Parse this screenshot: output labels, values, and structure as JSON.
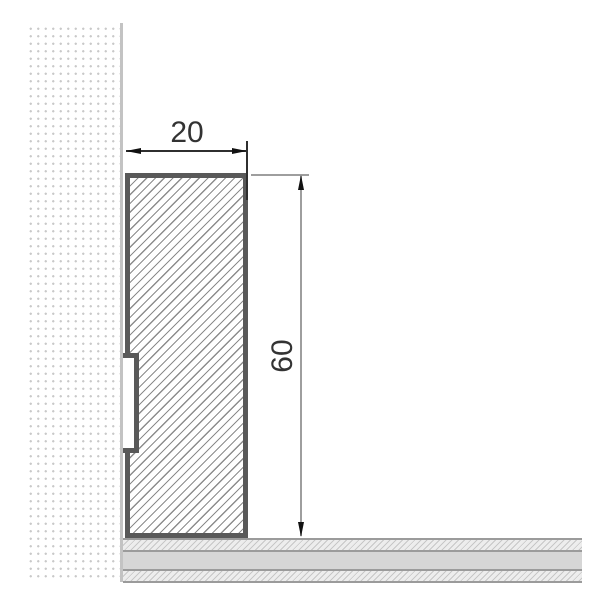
{
  "drawing": {
    "scene": "skirting-board-cross-section",
    "dimension_labels": {
      "width": "20",
      "height": "60"
    },
    "colors": {
      "background": "#ffffff",
      "profile_outline": "#595959",
      "profile_hatch_line": "#8c8c8c",
      "wall_dots": "#c9c9c9",
      "wall_edge_line": "#c3c3c3",
      "floor_lines": "#9b9b9b",
      "floor_band": "#d6d6d6",
      "floor_hatch_line": "#c7c7c7",
      "floor_hatch_bg": "#ededed",
      "dimension_line_dark": "#2f2f2f",
      "dimension_line_gray": "#9e9e9e",
      "arrowhead": "#111111",
      "label_text": "#333333"
    }
  }
}
